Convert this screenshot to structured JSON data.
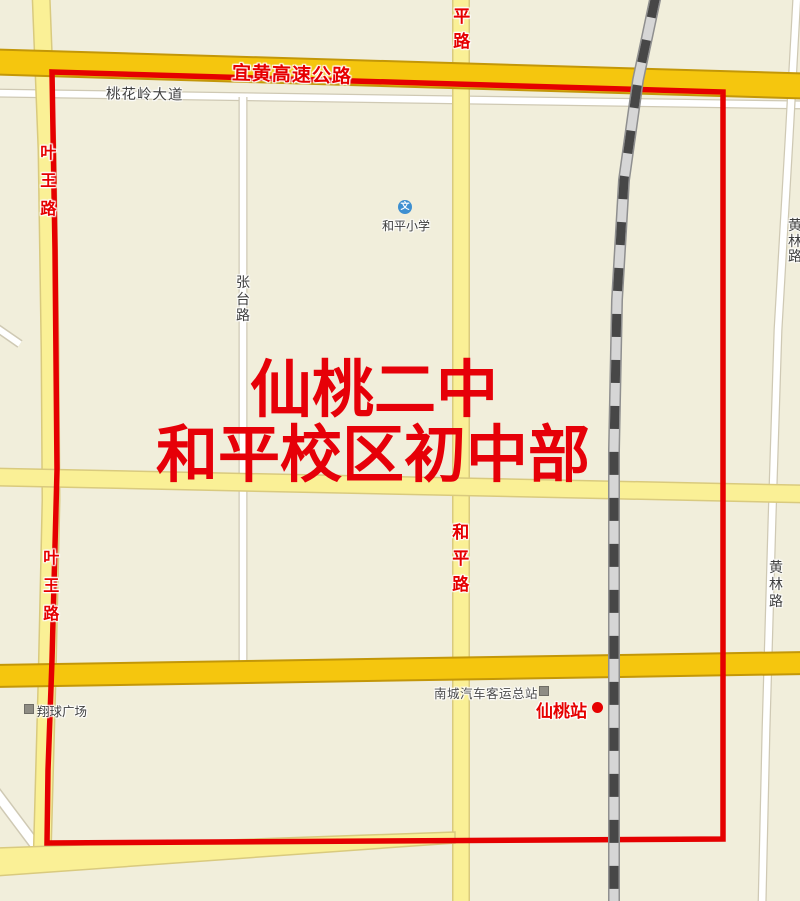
{
  "map_title": "仙桃二中和平校区初中部招生范围地图",
  "colors": {
    "background": "#f1eedb",
    "boundary_red": "#e50000",
    "label_red": "#e60000",
    "expressway_fill": "#f5c60e",
    "expressway_casing": "#c39708",
    "road_yellow_fill": "#faf096",
    "road_yellow_casing": "#d9ca7e",
    "road_white_fill": "#ffffff",
    "road_white_casing": "#cfc9b4",
    "railway_dark": "#474747",
    "railway_light": "#d6d6d6",
    "railway_casing": "#8f8f8f",
    "school_blue": "#3d8fd1"
  },
  "zone_title": {
    "line1": "仙桃二中",
    "line2": "和平校区初中部"
  },
  "road_labels": {
    "expressway": "宜黄高速公路",
    "taohualing_avenue": "桃花岭大道",
    "yewang_road_north": "叶王路",
    "yewang_road_south": "叶王路",
    "zhangtai_road": "张台路",
    "heping_road_north": "平路",
    "heping_road_mid": "和平路",
    "huanglin_road_north": "黄林路",
    "huanglin_road_south": "黄林路"
  },
  "pois": {
    "heping_primary_school": {
      "label": "和平小学",
      "icon_glyph": "文"
    },
    "nancheng_bus_terminal": {
      "label": "南城汽车客运总站"
    },
    "xiantao_station": {
      "label": "仙桃站"
    },
    "xiangqiu_plaza": {
      "label": "翔球广场"
    }
  }
}
